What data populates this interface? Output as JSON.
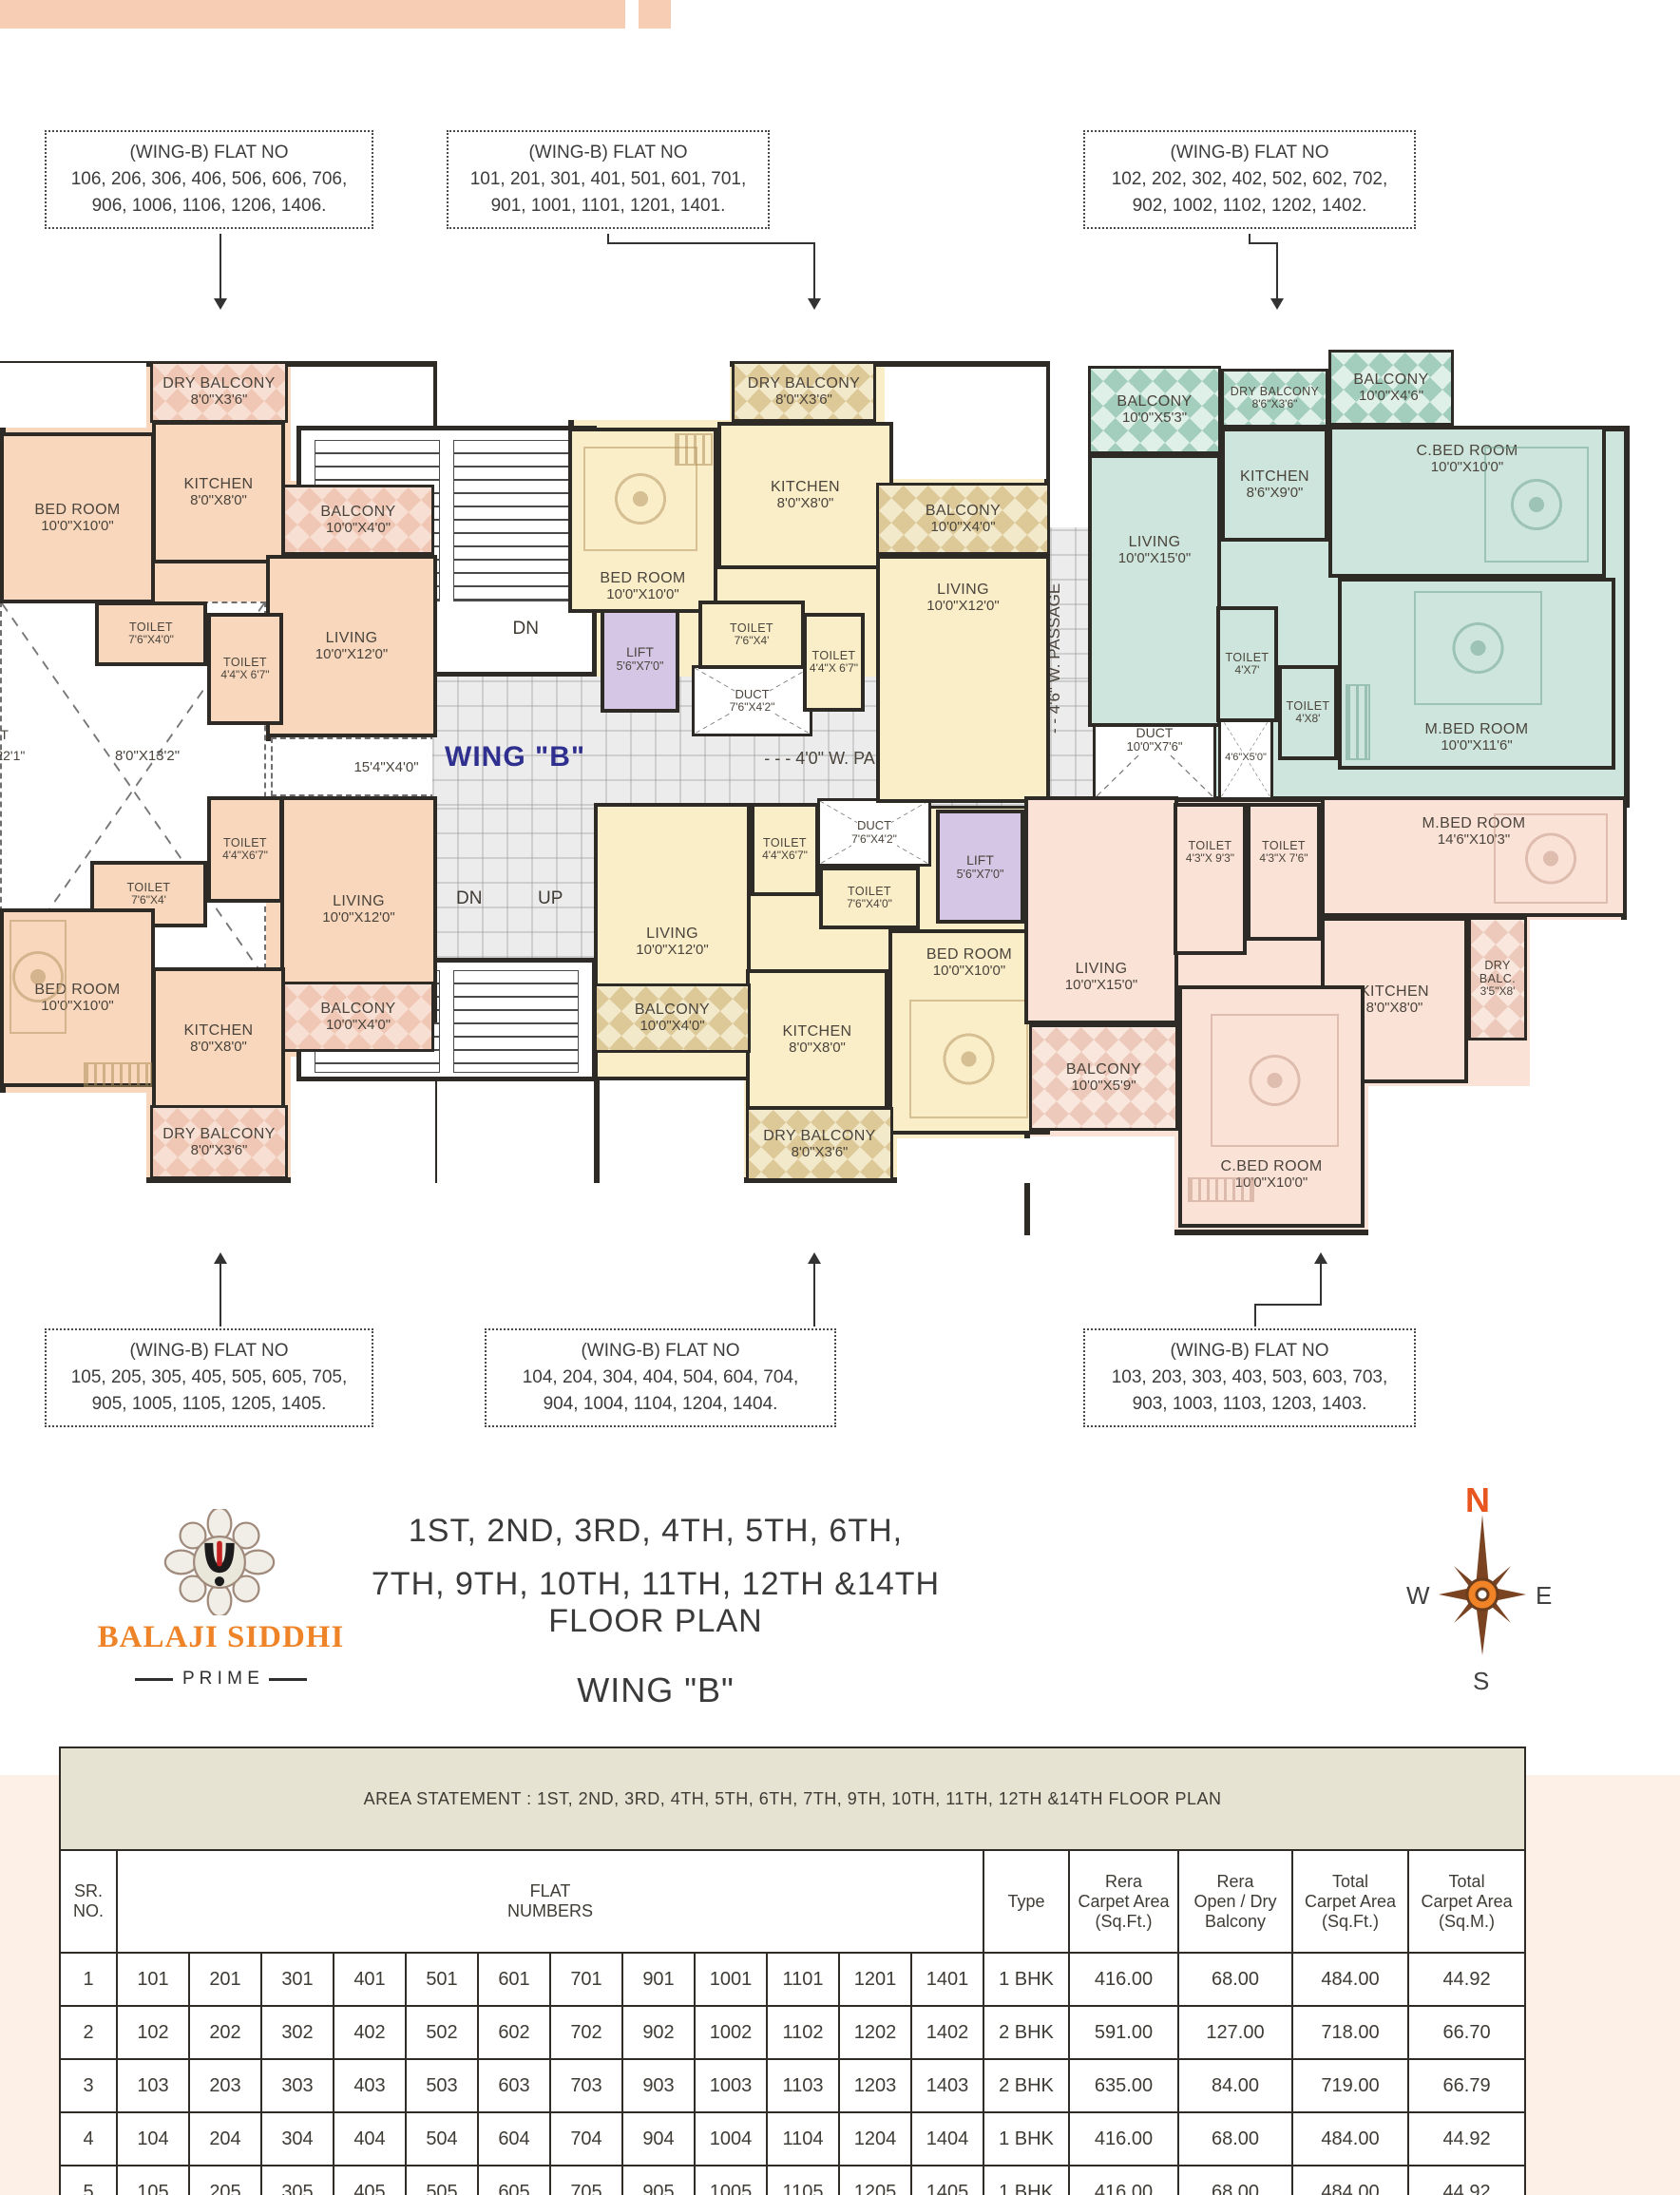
{
  "strip_color": "#f7cdb3",
  "callouts": {
    "top": [
      {
        "l1": "(WING-B) FLAT NO",
        "l2": "106, 206, 306, 406, 506, 606, 706,",
        "l3": "906, 1006, 1106, 1206, 1406."
      },
      {
        "l1": "(WING-B) FLAT NO",
        "l2": "101, 201, 301, 401, 501, 601, 701,",
        "l3": "901, 1001, 1101, 1201, 1401."
      },
      {
        "l1": "(WING-B) FLAT NO",
        "l2": "102, 202, 302, 402, 502, 602, 702,",
        "l3": "902, 1002, 1102, 1202, 1402."
      }
    ],
    "bottom": [
      {
        "l1": "(WING-B) FLAT NO",
        "l2": "105, 205, 305, 405, 505, 605, 705,",
        "l3": "905, 1005, 1105, 1205, 1405."
      },
      {
        "l1": "(WING-B) FLAT NO",
        "l2": "104, 204, 304, 404, 504, 604, 704,",
        "l3": "904, 1004, 1104, 1204, 1404."
      },
      {
        "l1": "(WING-B) FLAT NO",
        "l2": "103, 203, 303, 403, 503, 603, 703,",
        "l3": "903, 1003, 1103, 1203, 1403."
      }
    ]
  },
  "plan": {
    "wing_label": "WING \"B\"",
    "passage_h": "- - -  4'0\" W. PASSAGE  - - -",
    "passage_v": "- -  4'6\" W. PASSAGE",
    "stairs": {
      "up": "UP",
      "dn": "DN"
    },
    "lift": {
      "name": "LIFT",
      "dims": "5'6\"X7'0\""
    },
    "ducts": {
      "d1": {
        "name": "DUCT",
        "dims": "7'6\"X4'2\""
      },
      "d2": {
        "name": "DUCT",
        "dims": "10'0\"X7'6\""
      },
      "d3": {
        "dims": "4'6\"X5'0\""
      },
      "left": {
        "name": "DUCT",
        "dims": "X22'1\""
      },
      "open1": {
        "dims": "8'0\"X13'2\""
      },
      "open2": {
        "dims": "15'4\"X4'0\""
      }
    },
    "rooms": {
      "tl_dry": {
        "name": "DRY BALCONY",
        "dims": "8'0\"X3'6\""
      },
      "tl_kitchen": {
        "name": "KITCHEN",
        "dims": "8'0\"X8'0\""
      },
      "tl_bed": {
        "name": "BED ROOM",
        "dims": "10'0\"X10'0\""
      },
      "tl_balc": {
        "name": "BALCONY",
        "dims": "10'0\"X4'0\""
      },
      "tl_living": {
        "name": "LIVING",
        "dims": "10'0\"X12'0\""
      },
      "tl_t1": {
        "name": "TOILET",
        "dims": "7'6\"X4'0\""
      },
      "tl_t2": {
        "name": "TOILET",
        "dims": "4'4\"X 6'7\""
      },
      "bl_t2": {
        "name": "TOILET",
        "dims": "4'4\"X6'7\""
      },
      "bl_t1": {
        "name": "TOILET",
        "dims": "7'6\"X4'"
      },
      "bl_bed": {
        "name": "BED ROOM",
        "dims": "10'0\"X10'0\""
      },
      "bl_living": {
        "name": "LIVING",
        "dims": "10'0\"X12'0\""
      },
      "bl_kitchen": {
        "name": "KITCHEN",
        "dims": "8'0\"X8'0\""
      },
      "bl_balc": {
        "name": "BALCONY",
        "dims": "10'0\"X4'0\""
      },
      "bl_dry": {
        "name": "DRY BALCONY",
        "dims": "8'0\"X3'6\""
      },
      "tm_dry": {
        "name": "DRY BALCONY",
        "dims": "8'0\"X3'6\""
      },
      "tm_kitchen": {
        "name": "KITCHEN",
        "dims": "8'0\"X8'0\""
      },
      "tm_bed": {
        "name": "BED ROOM",
        "dims": "10'0\"X10'0\""
      },
      "tm_balc": {
        "name": "BALCONY",
        "dims": "10'0\"X4'0\""
      },
      "tm_living": {
        "name": "LIVING",
        "dims": "10'0\"X12'0\""
      },
      "tm_t1": {
        "name": "TOILET",
        "dims": "7'6\"X4'"
      },
      "tm_t2": {
        "name": "TOILET",
        "dims": "4'4\"X 6'7\""
      },
      "bm_living": {
        "name": "LIVING",
        "dims": "10'0\"X12'0\""
      },
      "bm_t2": {
        "name": "TOILET",
        "dims": "4'4\"X6'7\""
      },
      "bm_t1": {
        "name": "TOILET",
        "dims": "7'6\"X4'0\""
      },
      "bm_bed": {
        "name": "BED ROOM",
        "dims": "10'0\"X10'0\""
      },
      "bm_kitchen": {
        "name": "KITCHEN",
        "dims": "8'0\"X8'0\""
      },
      "bm_balc": {
        "name": "BALCONY",
        "dims": "10'0\"X4'0\""
      },
      "bm_dry": {
        "name": "DRY BALCONY",
        "dims": "8'0\"X3'6\""
      },
      "tr_balc1": {
        "name": "BALCONY",
        "dims": "10'0\"X5'3\""
      },
      "tr_dry": {
        "name": "DRY BALCONY",
        "dims": "8'6\"X3'6\""
      },
      "tr_balc2": {
        "name": "BALCONY",
        "dims": "10'0\"X4'6\""
      },
      "tr_kitchen": {
        "name": "KITCHEN",
        "dims": "8'6\"X9'0\""
      },
      "tr_cbed": {
        "name": "C.BED ROOM",
        "dims": "10'0\"X10'0\""
      },
      "tr_living": {
        "name": "LIVING",
        "dims": "10'0\"X15'0\""
      },
      "tr_t1": {
        "name": "TOILET",
        "dims": "4'X7'"
      },
      "tr_t2": {
        "name": "TOILET",
        "dims": "4'X8'"
      },
      "tr_mbed": {
        "name": "M.BED ROOM",
        "dims": "10'0\"X11'6\""
      },
      "br_living": {
        "name": "LIVING",
        "dims": "10'0\"X15'0\""
      },
      "br_t1": {
        "name": "TOILET",
        "dims": "4'3\"X 9'3\""
      },
      "br_t2": {
        "name": "TOILET",
        "dims": "4'3\"X 7'6\""
      },
      "br_mbed": {
        "name": "M.BED ROOM",
        "dims": "14'6\"X10'3\""
      },
      "br_kitchen": {
        "name": "KITCHEN",
        "dims": "8'0\"X8'0\""
      },
      "br_dry": {
        "name": "DRY BALC.",
        "dims": "3'5\"X8'"
      },
      "br_balc": {
        "name": "BALCONY",
        "dims": "10'0\"X5'9\""
      },
      "br_cbed": {
        "name": "C.BED ROOM",
        "dims": "10'0\"X10'0\""
      }
    }
  },
  "footer": {
    "title_line1": "1ST, 2ND, 3RD, 4TH, 5TH, 6TH,",
    "title_line2": "7TH, 9TH, 10TH, 11TH, 12TH &14TH FLOOR PLAN",
    "wing": "WING  \"B\"",
    "brand": "BALAJI SIDDHI",
    "brand_sub": "P R I M E"
  },
  "compass": {
    "n": "N",
    "s": "S",
    "e": "E",
    "w": "W"
  },
  "table": {
    "title": "AREA STATEMENT : 1ST, 2ND, 3RD, 4TH, 5TH, 6TH, 7TH, 9TH, 10TH, 11TH, 12TH &14TH FLOOR PLAN",
    "headers": {
      "sr": "SR.\nNO.",
      "flat": "FLAT\nNUMBERS",
      "type": "Type",
      "rera_carpet": "Rera\nCarpet Area\n(Sq.Ft.)",
      "rera_open": "Rera\nOpen / Dry\nBalcony",
      "total_ft": "Total\nCarpet Area\n(Sq.Ft.)",
      "total_m": "Total\nCarpet Area\n(Sq.M.)"
    },
    "rows": [
      {
        "sr": "1",
        "flats": [
          "101",
          "201",
          "301",
          "401",
          "501",
          "601",
          "701",
          "901",
          "1001",
          "1101",
          "1201",
          "1401"
        ],
        "type": "1 BHK",
        "rera": "416.00",
        "open": "68.00",
        "total_ft": "484.00",
        "total_m": "44.92"
      },
      {
        "sr": "2",
        "flats": [
          "102",
          "202",
          "302",
          "402",
          "502",
          "602",
          "702",
          "902",
          "1002",
          "1102",
          "1202",
          "1402"
        ],
        "type": "2 BHK",
        "rera": "591.00",
        "open": "127.00",
        "total_ft": "718.00",
        "total_m": "66.70"
      },
      {
        "sr": "3",
        "flats": [
          "103",
          "203",
          "303",
          "403",
          "503",
          "603",
          "703",
          "903",
          "1003",
          "1103",
          "1203",
          "1403"
        ],
        "type": "2 BHK",
        "rera": "635.00",
        "open": "84.00",
        "total_ft": "719.00",
        "total_m": "66.79"
      },
      {
        "sr": "4",
        "flats": [
          "104",
          "204",
          "304",
          "404",
          "504",
          "604",
          "704",
          "904",
          "1004",
          "1104",
          "1204",
          "1404"
        ],
        "type": "1 BHK",
        "rera": "416.00",
        "open": "68.00",
        "total_ft": "484.00",
        "total_m": "44.92"
      },
      {
        "sr": "5",
        "flats": [
          "105",
          "205",
          "305",
          "405",
          "505",
          "605",
          "705",
          "905",
          "1005",
          "1105",
          "1205",
          "1405"
        ],
        "type": "1 BHK",
        "rera": "416.00",
        "open": "68.00",
        "total_ft": "484.00",
        "total_m": "44.92"
      },
      {
        "sr": "6",
        "flats": [
          "106",
          "206",
          "306",
          "406",
          "506",
          "606",
          "706",
          "906",
          "1006",
          "1106",
          "1206",
          "1406"
        ],
        "type": "1 BHK",
        "rera": "416.00",
        "open": "68.00",
        "total_ft": "484.00",
        "total_m": "44.92"
      }
    ]
  }
}
